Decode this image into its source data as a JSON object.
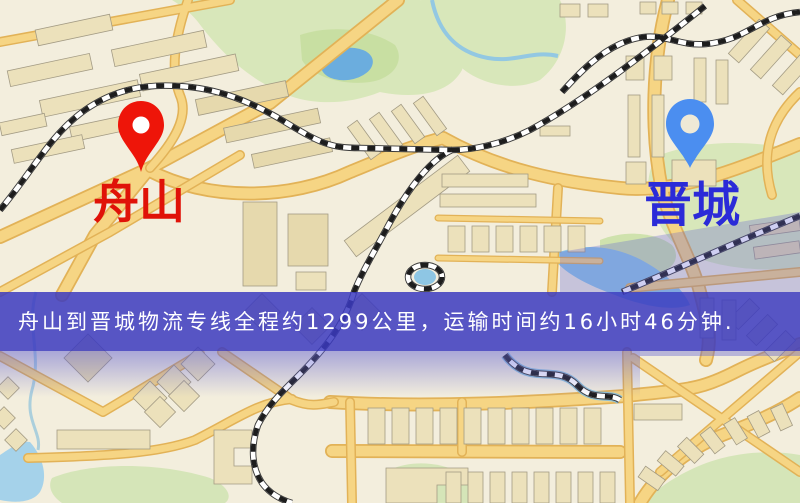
{
  "banner": {
    "text": "舟山到晋城物流专线全程约1299公里，运输时间约16小时46分钟.",
    "background": "#3b39c0",
    "text_color": "#ffffff"
  },
  "origin": {
    "label": "舟山",
    "label_color": "#e01208",
    "pin_color": "#ee1509",
    "pin_icon": "red-location-pin-icon"
  },
  "destination": {
    "label": "晋城",
    "label_color": "#2b2bd8",
    "pin_color": "#4b8ef0",
    "pin_icon": "blue-location-pin-icon"
  },
  "map_colors": {
    "background": "#f3eedd",
    "road": "#f6d584",
    "road_casing": "#e2b257",
    "green_area": "#d8e7ba",
    "water": "#8ec6e4",
    "railway": "#1d1d1d",
    "building": "#ece1bb",
    "overlay": "#6060d2"
  }
}
